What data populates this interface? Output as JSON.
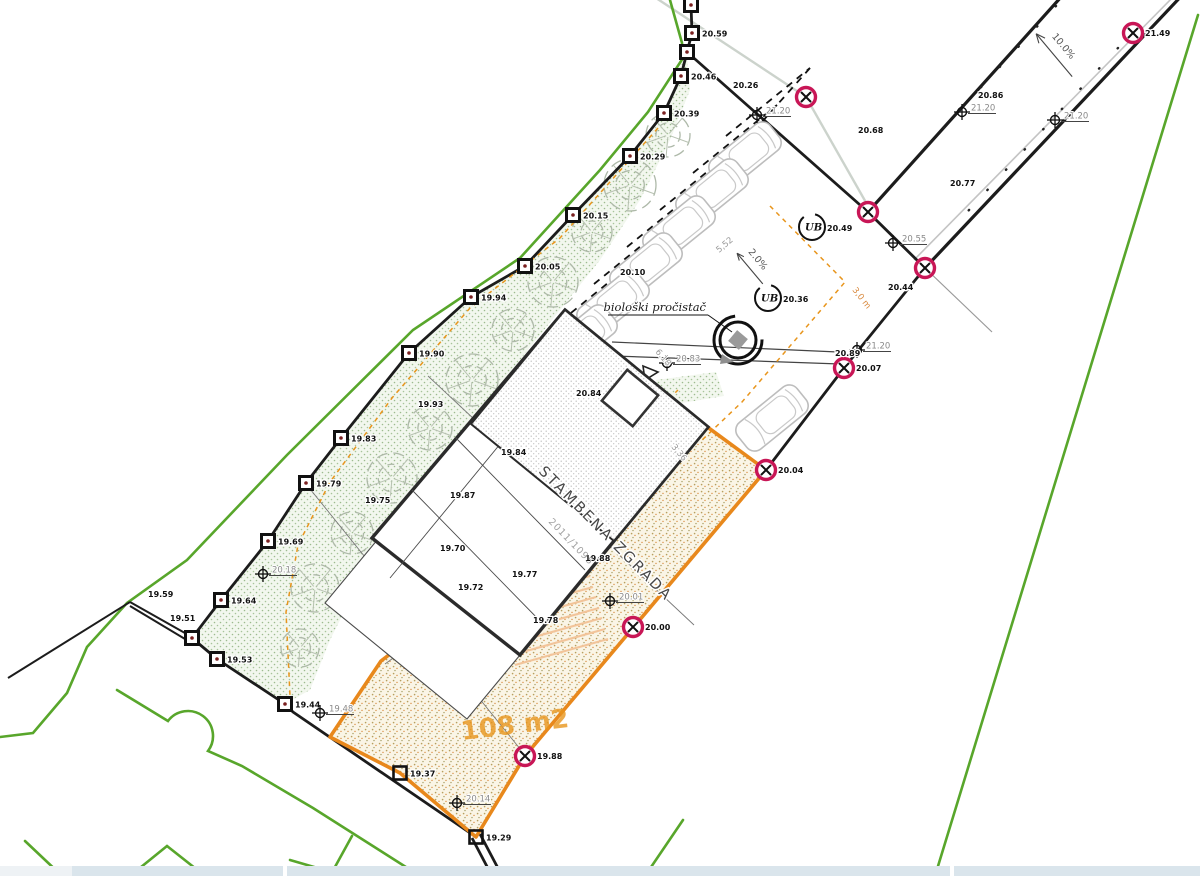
{
  "palette": {
    "boundary_black": "#1c1c1c",
    "adjacent_parcel_green": "#58a62b",
    "orange_parcel": "#e8881c",
    "orange_dashed": "#e8951c",
    "magenta_marker": "#c81656",
    "landscape_dot_green": "#a8c49a",
    "building_hatch_gray": "#bdbdbd",
    "olive_hatch": "#b79f5e",
    "road_curb_gray": "#c4c4c4",
    "utility_line_gray": "#ccd3cc",
    "bottom_bar_fill": "#dae5ec"
  },
  "texts": {
    "building_label": "STAMBENA ZGRADA",
    "purifier_label": "biološki pročistač",
    "area_label": "108 m2",
    "parcel_number": "2011/1095",
    "road_slope_label": "10.0%",
    "yard_slope_label": "2.0%",
    "ub_label": "UB",
    "dim_entrance": "6.18",
    "dim_walkway": "3,36",
    "dim_stall": "5,52",
    "dim_setback": "3,0 m"
  },
  "annotations": {
    "survey_markers": [
      {
        "x": 691,
        "y": 5,
        "label": ""
      },
      {
        "x": 692,
        "y": 33,
        "label": "20.59"
      },
      {
        "x": 687,
        "y": 52,
        "label": ""
      },
      {
        "x": 681,
        "y": 76,
        "label": "20.46"
      },
      {
        "x": 664,
        "y": 113,
        "label": "20.39"
      },
      {
        "x": 630,
        "y": 156,
        "label": "20.29"
      },
      {
        "x": 573,
        "y": 215,
        "label": "20.15"
      },
      {
        "x": 525,
        "y": 266,
        "label": "20.05"
      },
      {
        "x": 471,
        "y": 297,
        "label": "19.94"
      },
      {
        "x": 409,
        "y": 353,
        "label": "19.90"
      },
      {
        "x": 341,
        "y": 438,
        "label": "19.83"
      },
      {
        "x": 306,
        "y": 483,
        "label": "19.79"
      },
      {
        "x": 268,
        "y": 541,
        "label": "19.69"
      },
      {
        "x": 221,
        "y": 600,
        "label": "19.64"
      },
      {
        "x": 192,
        "y": 638,
        "label": ""
      },
      {
        "x": 217,
        "y": 659,
        "label": "19.53"
      },
      {
        "x": 285,
        "y": 704,
        "label": "19.44"
      },
      {
        "x": 400,
        "y": 773,
        "label": "19.37",
        "open": true
      },
      {
        "x": 476,
        "y": 837,
        "label": "19.29",
        "open": true
      }
    ],
    "magenta_markers": [
      {
        "x": 806,
        "y": 97,
        "label": ""
      },
      {
        "x": 868,
        "y": 212,
        "label": ""
      },
      {
        "x": 925,
        "y": 268,
        "label": ""
      },
      {
        "x": 1133,
        "y": 33,
        "label": "21.49"
      },
      {
        "x": 844,
        "y": 368,
        "label": "20.07"
      },
      {
        "x": 766,
        "y": 470,
        "label": "20.04"
      },
      {
        "x": 525,
        "y": 756,
        "label": "19.88"
      },
      {
        "x": 633,
        "y": 627,
        "label": "20.00"
      }
    ],
    "crosses": [
      {
        "x": 757,
        "y": 115,
        "label": "21.20"
      },
      {
        "x": 962,
        "y": 112,
        "label": "21.20"
      },
      {
        "x": 1055,
        "y": 120,
        "label": "21.20"
      },
      {
        "x": 893,
        "y": 243,
        "label": "20.55"
      },
      {
        "x": 857,
        "y": 350,
        "label": "21.20"
      },
      {
        "x": 667,
        "y": 363,
        "label": "20.83"
      },
      {
        "x": 263,
        "y": 574,
        "label": "20.18"
      },
      {
        "x": 610,
        "y": 601,
        "label": "20.01"
      },
      {
        "x": 457,
        "y": 803,
        "label": "20.14"
      },
      {
        "x": 320,
        "y": 713,
        "label": "19.48"
      }
    ],
    "elevation_labels": [
      {
        "x": 733,
        "y": 88,
        "t": "20.26"
      },
      {
        "x": 978,
        "y": 98,
        "t": "20.86"
      },
      {
        "x": 858,
        "y": 133,
        "t": "20.68"
      },
      {
        "x": 950,
        "y": 186,
        "t": "20.77"
      },
      {
        "x": 888,
        "y": 290,
        "t": "20.44"
      },
      {
        "x": 835,
        "y": 356,
        "t": "20.89"
      },
      {
        "x": 576,
        "y": 396,
        "t": "20.84"
      },
      {
        "x": 501,
        "y": 455,
        "t": "19.84"
      },
      {
        "x": 450,
        "y": 498,
        "t": "19.87"
      },
      {
        "x": 440,
        "y": 551,
        "t": "19.70"
      },
      {
        "x": 458,
        "y": 590,
        "t": "19.72"
      },
      {
        "x": 512,
        "y": 577,
        "t": "19.77"
      },
      {
        "x": 585,
        "y": 561,
        "t": "19.88"
      },
      {
        "x": 533,
        "y": 623,
        "t": "19.78"
      },
      {
        "x": 418,
        "y": 407,
        "t": "19.93"
      },
      {
        "x": 365,
        "y": 503,
        "t": "19.75"
      },
      {
        "x": 620,
        "y": 275,
        "t": "20.10"
      },
      {
        "x": 148,
        "y": 597,
        "t": "19.59"
      },
      {
        "x": 170,
        "y": 621,
        "t": "19.51"
      }
    ],
    "ub_circles": [
      {
        "x": 812,
        "y": 227,
        "label": "20.49"
      },
      {
        "x": 768,
        "y": 298,
        "label": "20.36"
      }
    ],
    "cars": [
      {
        "x": 745,
        "y": 155
      },
      {
        "x": 712,
        "y": 192
      },
      {
        "x": 679,
        "y": 229
      },
      {
        "x": 646,
        "y": 266
      },
      {
        "x": 613,
        "y": 303
      },
      {
        "x": 581,
        "y": 338
      },
      {
        "x": 772,
        "y": 418
      }
    ],
    "trees": [
      {
        "x": 668,
        "y": 135,
        "r": 22
      },
      {
        "x": 630,
        "y": 185,
        "r": 26
      },
      {
        "x": 592,
        "y": 232,
        "r": 20
      },
      {
        "x": 553,
        "y": 282,
        "r": 25
      },
      {
        "x": 513,
        "y": 330,
        "r": 21
      },
      {
        "x": 472,
        "y": 380,
        "r": 26
      },
      {
        "x": 430,
        "y": 428,
        "r": 22
      },
      {
        "x": 392,
        "y": 478,
        "r": 25
      },
      {
        "x": 352,
        "y": 533,
        "r": 21
      },
      {
        "x": 315,
        "y": 588,
        "r": 24
      },
      {
        "x": 300,
        "y": 648,
        "r": 19
      }
    ]
  }
}
